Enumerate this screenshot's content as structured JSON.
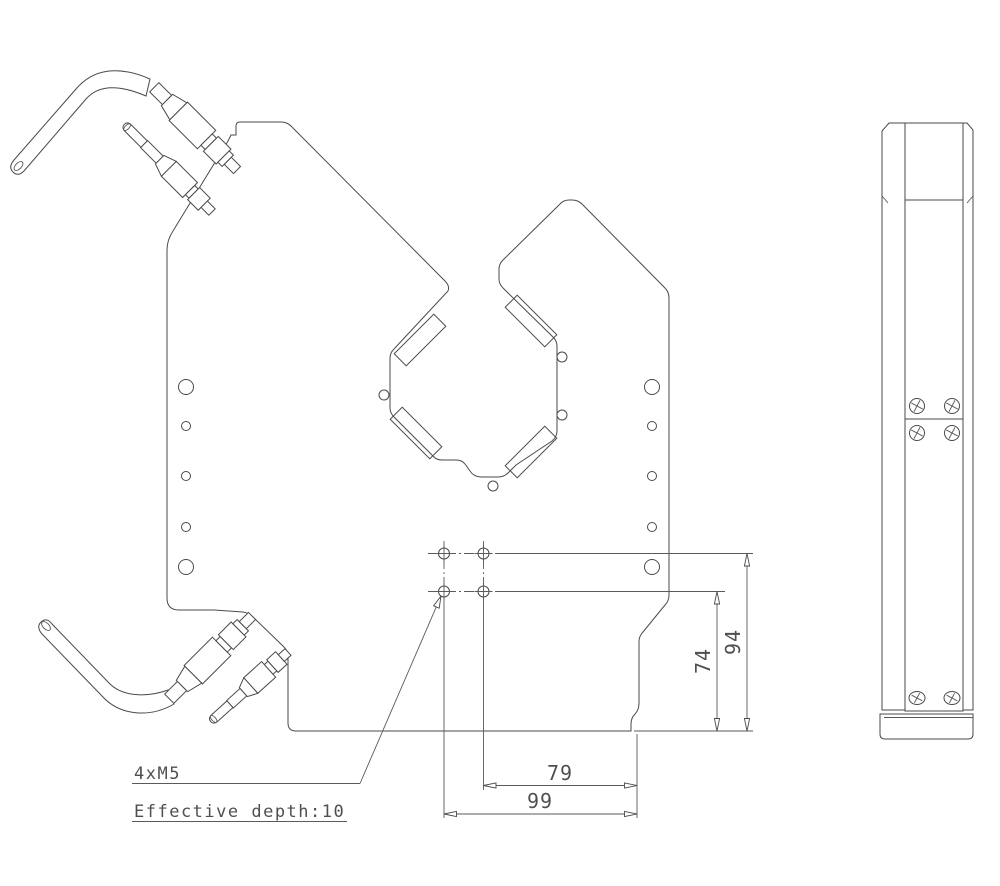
{
  "drawing": {
    "background": "#ffffff",
    "line_color": "#4a4a4a",
    "annotations": {
      "thread_callout": "4xM5",
      "depth_note": "Effective depth:10"
    },
    "dimensions": {
      "hole_span_outer": "99",
      "hole_span_inner": "79",
      "hole_height_inner": "74",
      "hole_height_outer": "94"
    }
  }
}
